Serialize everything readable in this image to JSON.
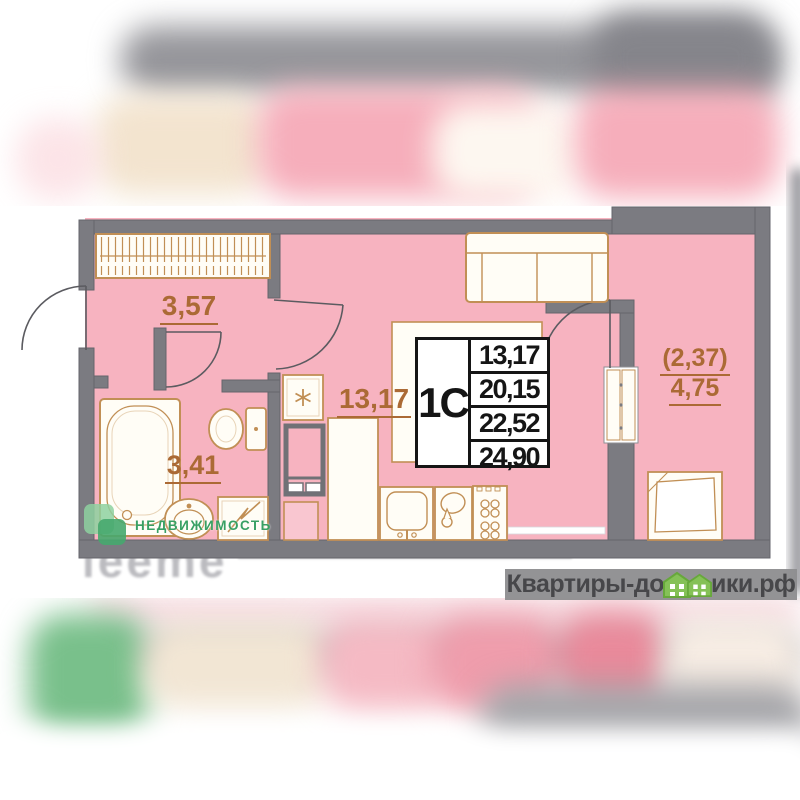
{
  "floor_plan": {
    "unit_type": "1С",
    "area_values": [
      "13,17",
      "20,15",
      "22,52",
      "24,90"
    ],
    "room_areas": {
      "hallway": "3,57",
      "bathroom": "3,41",
      "living_kitchen": "13,17",
      "balcony_coefficient": "(2,37)",
      "balcony": "4,75"
    }
  },
  "watermarks": {
    "agency": "НЕДВИЖИМОСТЬ",
    "faint_text": "leeme",
    "brand_prefix": "Квартиры-до",
    "brand_suffix": "ики.рф"
  },
  "icons": {
    "fridge_marker": "asterisk-snowflake",
    "brand_glyphs": "green-house-icons"
  },
  "colors": {
    "room_pink": "#f7b3c0",
    "wall_gray": "#7b7b81",
    "furniture_outline": "#c18f55",
    "label_orange": "#ab6a35",
    "agency_green": "#38a064",
    "brand_house_green": "#85c157",
    "brand_text": "#47474a"
  }
}
